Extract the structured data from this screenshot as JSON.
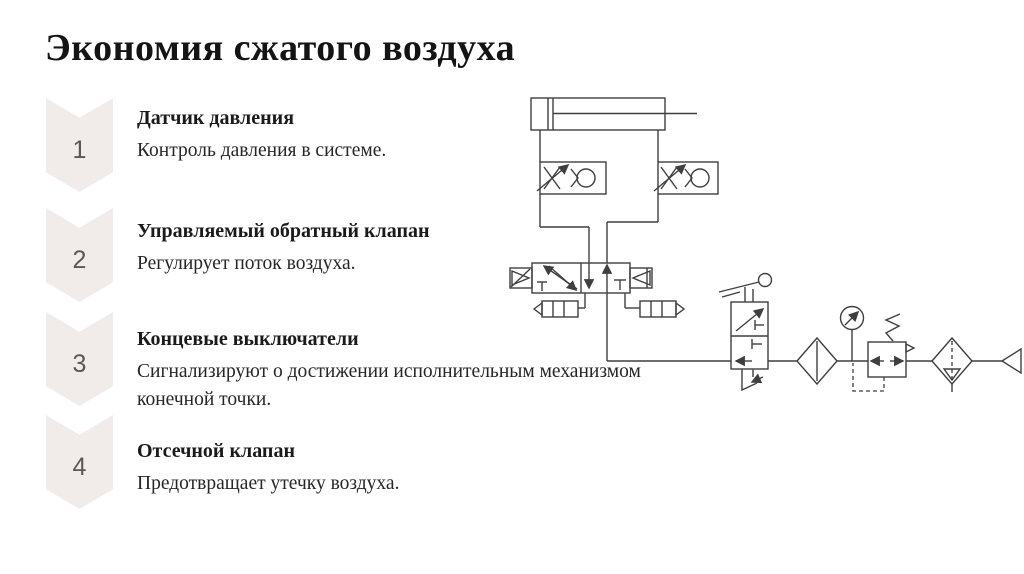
{
  "slide": {
    "title": "Экономия сжатого воздуха",
    "steps": [
      {
        "number": "1",
        "heading": "Датчик давления",
        "body": "Контроль давления в системе."
      },
      {
        "number": "2",
        "heading": "Управляемый обратный клапан",
        "body": "Регулирует поток воздуха."
      },
      {
        "number": "3",
        "heading": "Концевые выключатели",
        "body": "Сигнализируют о достижении исполнительным механизмом конечной точки."
      },
      {
        "number": "4",
        "heading": "Отсечной клапан",
        "body": "Предотвращает утечку воздуха."
      }
    ],
    "colors": {
      "background": "#ffffff",
      "chevron_fill": "#f1ecea",
      "number_text": "#585858",
      "title_text": "#141414",
      "body_text": "#262626",
      "diagram_line": "#3f3f3f"
    },
    "diagram": {
      "type": "pneumatic-circuit-schematic",
      "components": [
        "double-acting-cylinder",
        "one-way-flow-control-valve-left",
        "one-way-flow-control-valve-right",
        "pilot-operated-5-2-directional-valve",
        "exhaust-silencer-left",
        "exhaust-silencer-right",
        "lever-shutoff-valve",
        "air-filter",
        "pressure-gauge",
        "pressure-regulator",
        "filter-water-separator",
        "compressed-air-source"
      ]
    }
  }
}
